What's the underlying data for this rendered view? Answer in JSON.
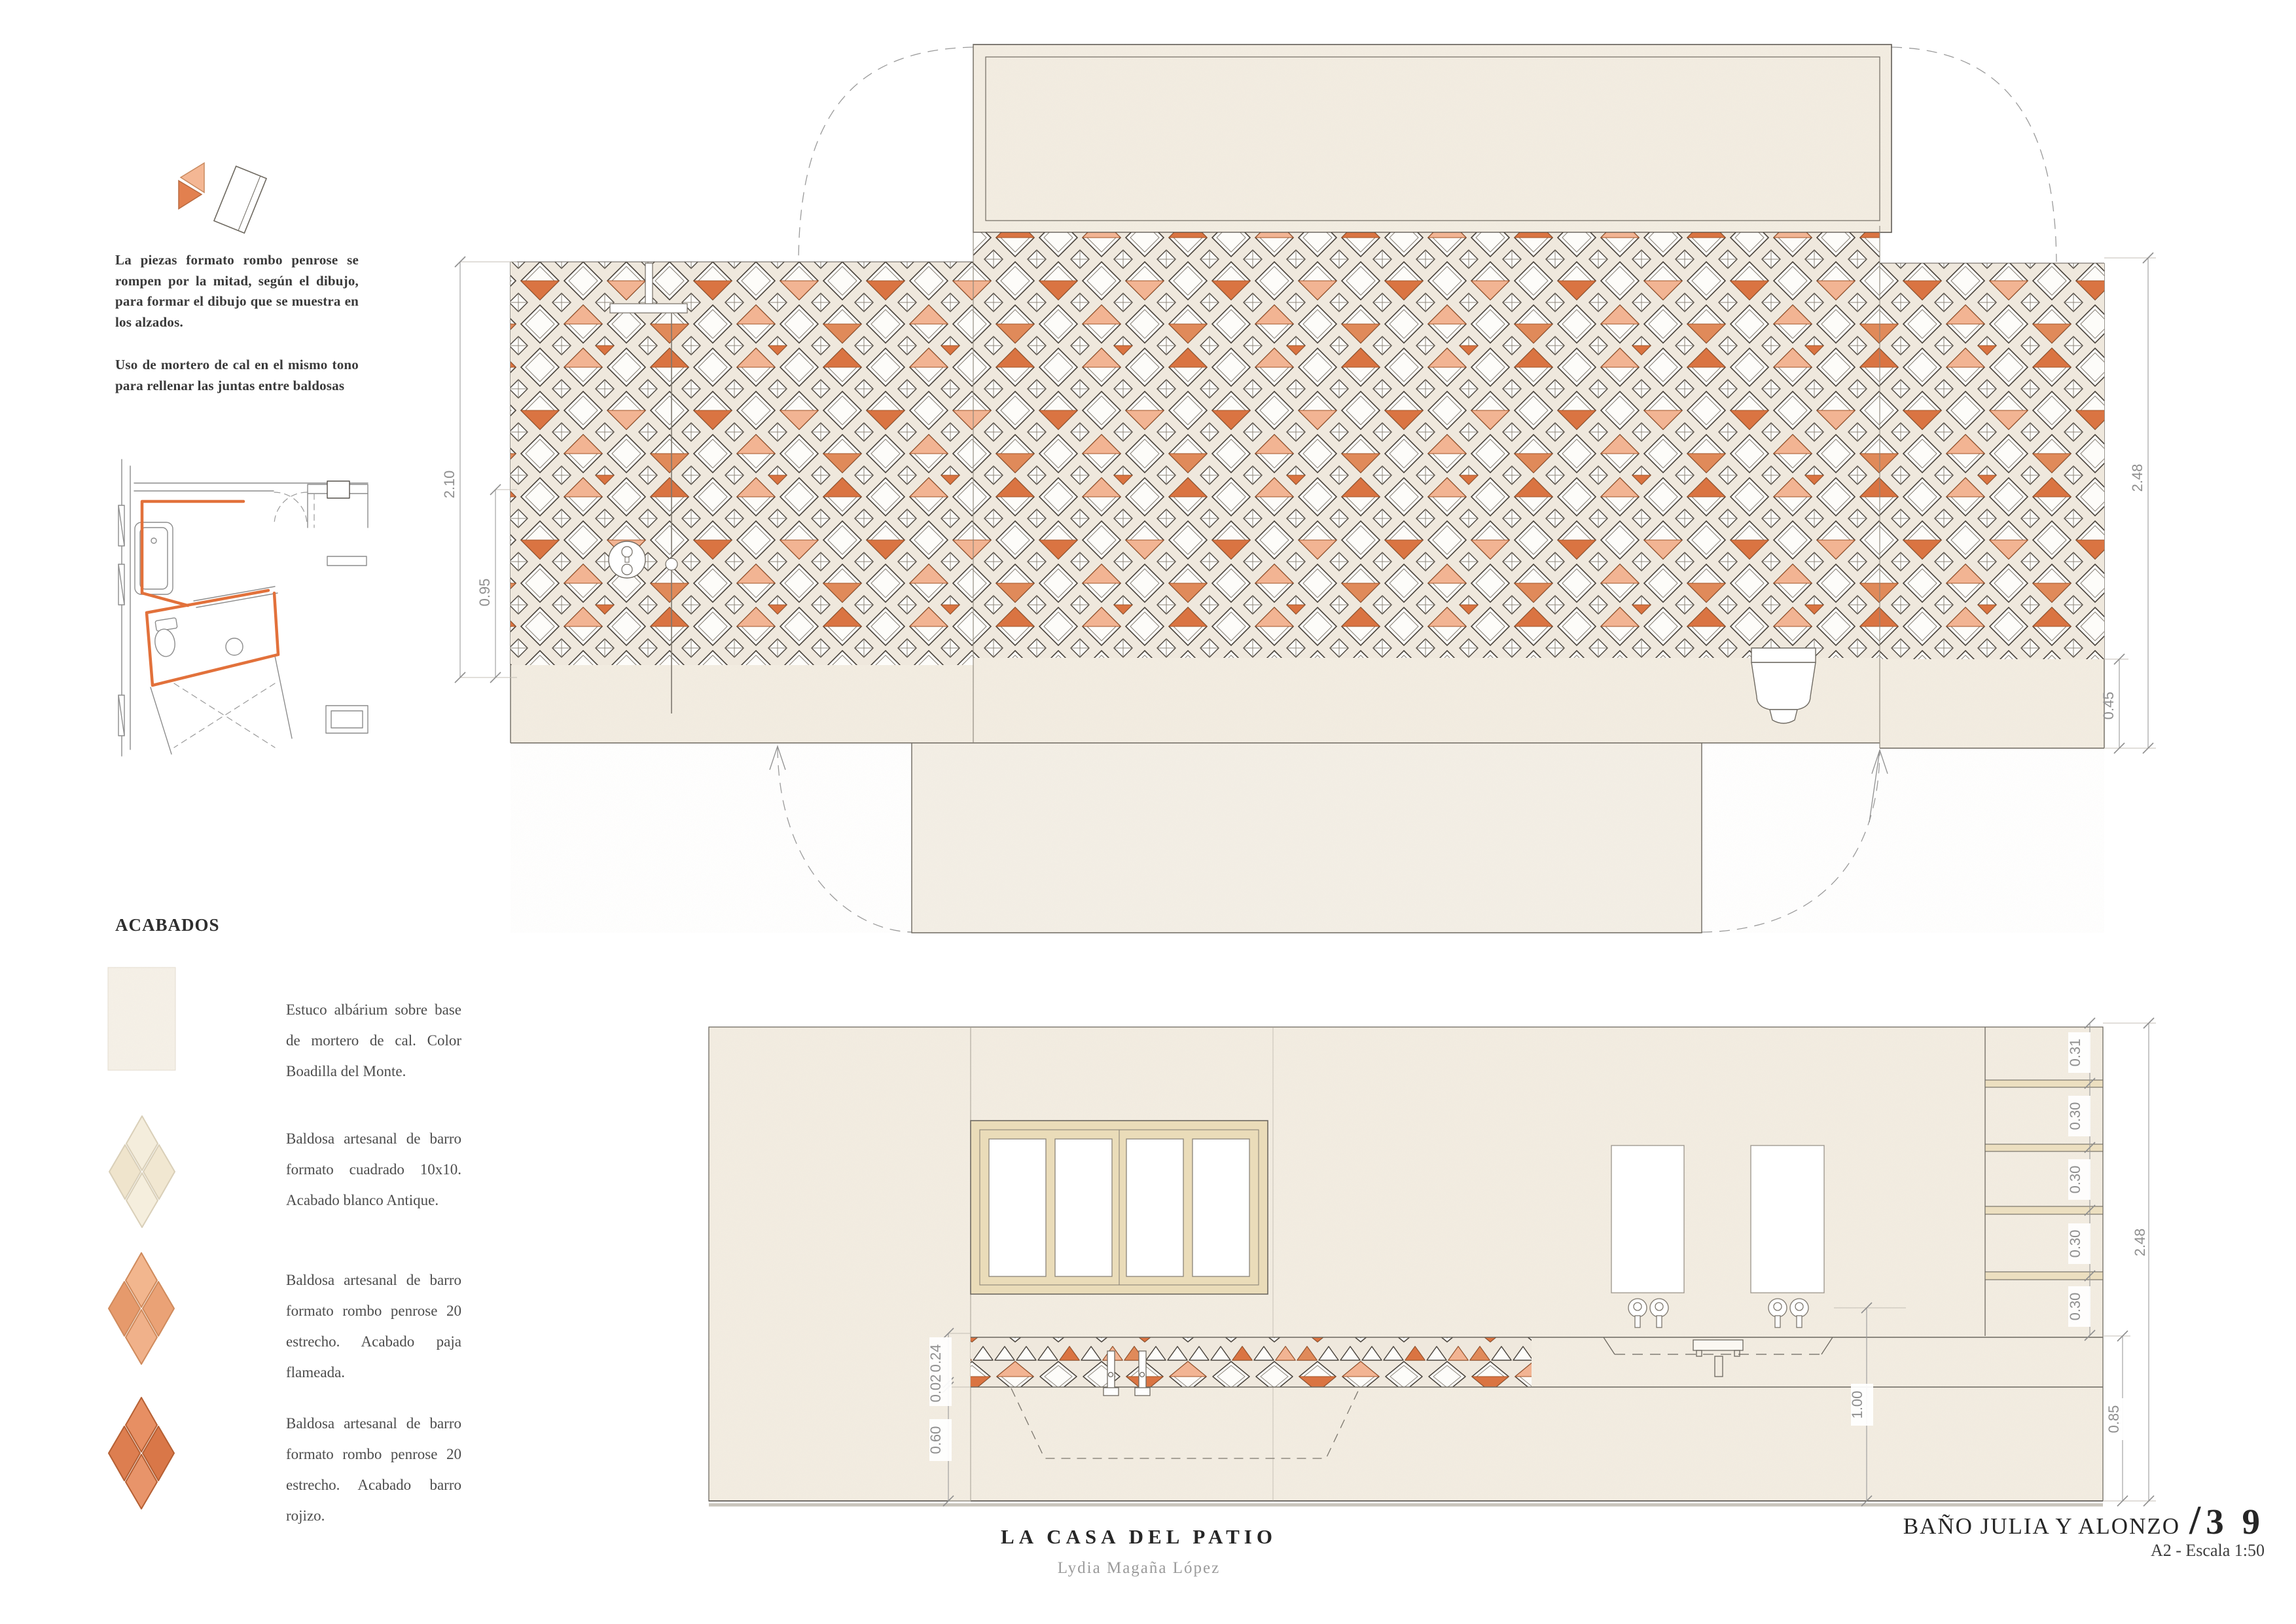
{
  "notes": {
    "tiles": "La piezas formato rombo penrose se rompen por la mitad, según el dibujo, para formar el dibujo que se muestra en los alzados.",
    "mortar": "Uso de mortero de cal en el mismo tono para rellenar las juntas entre baldosas"
  },
  "acabados": {
    "title": "ACABADOS",
    "items": [
      {
        "text": "Estuco albárium sobre base de mortero de cal. Color Boadilla del Monte."
      },
      {
        "text": "Baldosa artesanal de barro formato cuadrado 10x10. Acabado blanco Antique."
      },
      {
        "text": "Baldosa artesanal de barro formato rombo penrose 20 estrecho. Acabado paja flameada."
      },
      {
        "text": "Baldosa artesanal de barro formato rombo penrose 20 estrecho. Acabado barro rojizo."
      }
    ]
  },
  "dims": {
    "big": {
      "tiles_h": "2.10",
      "lower": "0.95",
      "total": "2.48",
      "base": "0.45"
    },
    "front": {
      "shelf": [
        "0.31",
        "0.30",
        "0.30",
        "0.30",
        "0.30"
      ],
      "total": "2.48",
      "counter": "0.85",
      "band": "0.24",
      "joint": "0.02",
      "below": "0.60",
      "tap": "1.00"
    }
  },
  "footer": {
    "project": "LA CASA DEL PATIO",
    "author": "Lydia Magaña López",
    "sheet": "BAÑO JULIA Y ALONZO",
    "slash": "/",
    "number": "3 9",
    "scale": "A2 - Escala 1:50"
  },
  "colors": {
    "accent_dark": "#DA7442",
    "accent_light": "#F2B493",
    "wall_beige": "#F3EDE2",
    "tile_joint": "#EFE8DD",
    "window_frame": "#EADCB9",
    "line_dark": "#55504A",
    "dim_gray": "#8F8F8F"
  }
}
